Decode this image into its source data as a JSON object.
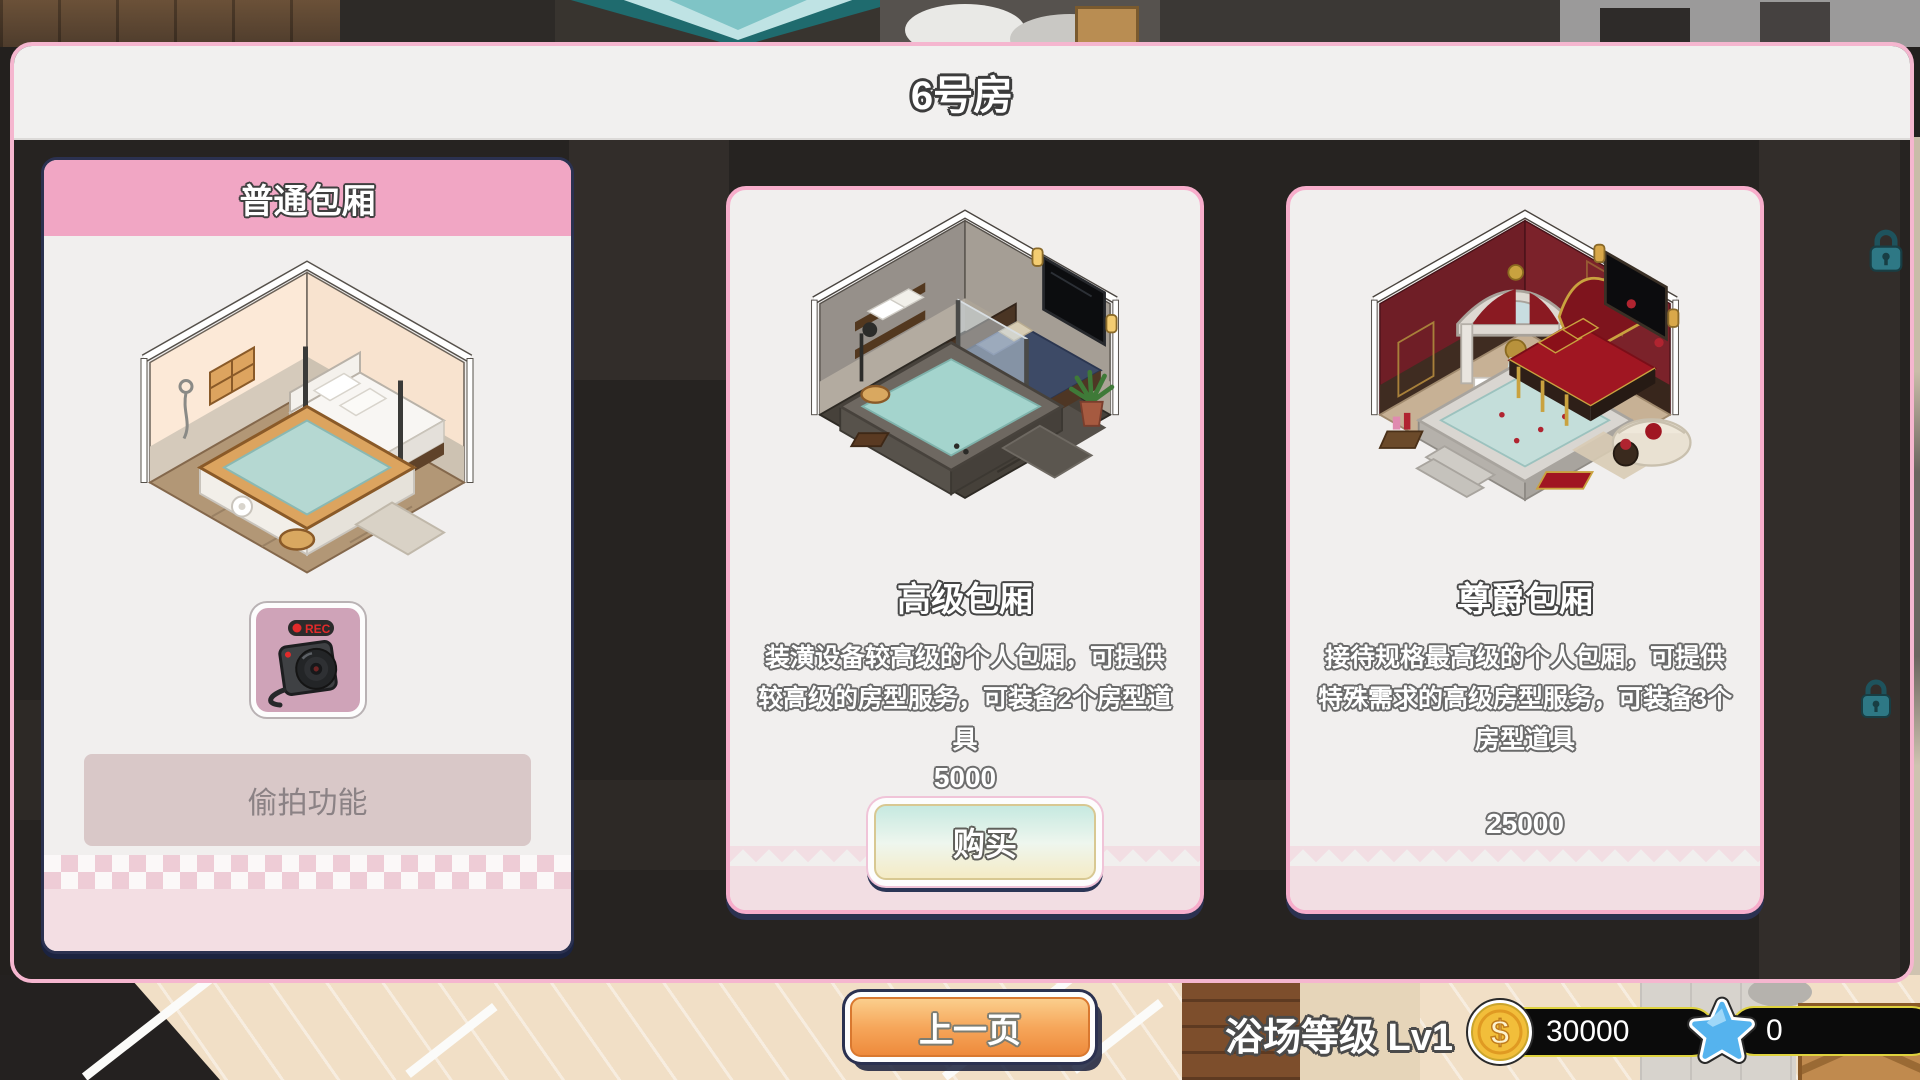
{
  "dialog": {
    "title": "6号房"
  },
  "cards": [
    {
      "id": "normal",
      "title": "普通包厢",
      "feature_label": "偷拍功能",
      "camera_rec": "REC"
    },
    {
      "id": "premium",
      "title": "高级包厢",
      "description": "装潢设备较高级的个人包厢，可提供较高级的房型服务，可装备2个房型道具",
      "price": "5000",
      "buy_label": "购买"
    },
    {
      "id": "noble",
      "title": "尊爵包厢",
      "description": "接待规格最高级的个人包厢，可提供特殊需求的高级房型服务，可装备3个房型道具",
      "price": "25000"
    }
  ],
  "footer": {
    "prev_label": "上一页",
    "level_label": "浴场等级 Lv1",
    "coin_symbol": "$",
    "coin_amount": "30000",
    "star_amount": "0"
  },
  "colors": {
    "accent_pink": "#f1a6c4",
    "navy_outline": "#2b3150",
    "orange_button": "#f09a4e",
    "coin_gold": "#f2be3a",
    "star_blue": "#55b3ee",
    "pill_border_yellow": "#ded23e"
  }
}
